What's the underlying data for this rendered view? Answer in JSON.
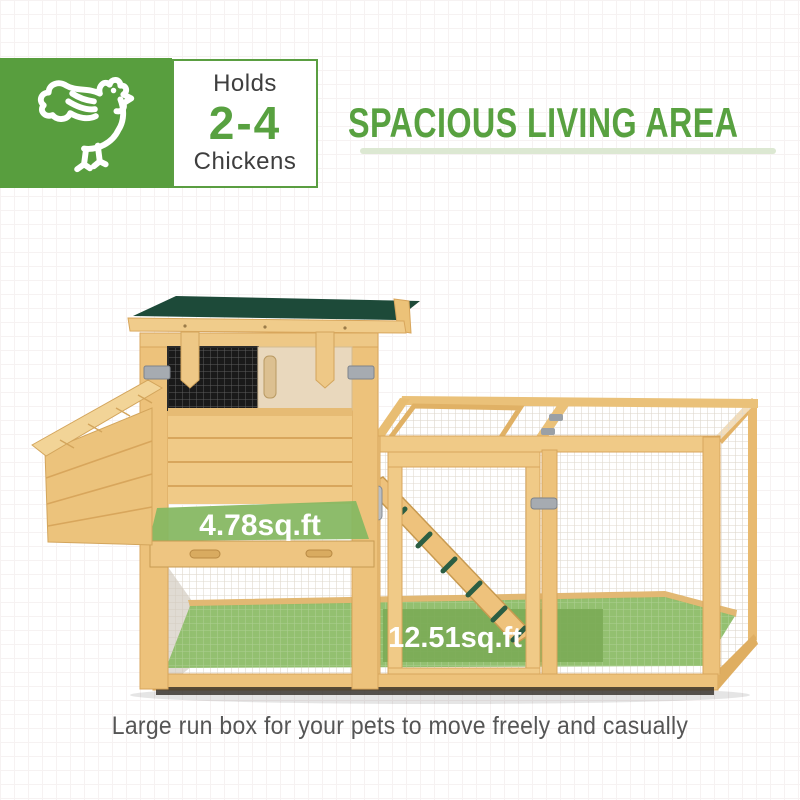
{
  "badge": {
    "capacity_prefix": "Holds",
    "capacity_range": "2-4",
    "capacity_suffix": "Chickens"
  },
  "header": {
    "title": "SPACIOUS LIVING AREA"
  },
  "coop": {
    "coop_floor_area": "4.78sq.ft",
    "run_floor_area": "12.51sq.ft"
  },
  "caption": "Large run box for your pets to move freely and casually",
  "icons": {
    "chicken": "chicken-icon"
  },
  "colors": {
    "brand_green": "#589e3e",
    "number_green": "#58a140",
    "underline_green": "#dce8d2",
    "overlay_green": "#86b862",
    "floor_green": "#8fbd6a",
    "roof_green": "#1d4a39",
    "wood_light": "#f0ca87",
    "text_dark": "#3e3e3e"
  }
}
